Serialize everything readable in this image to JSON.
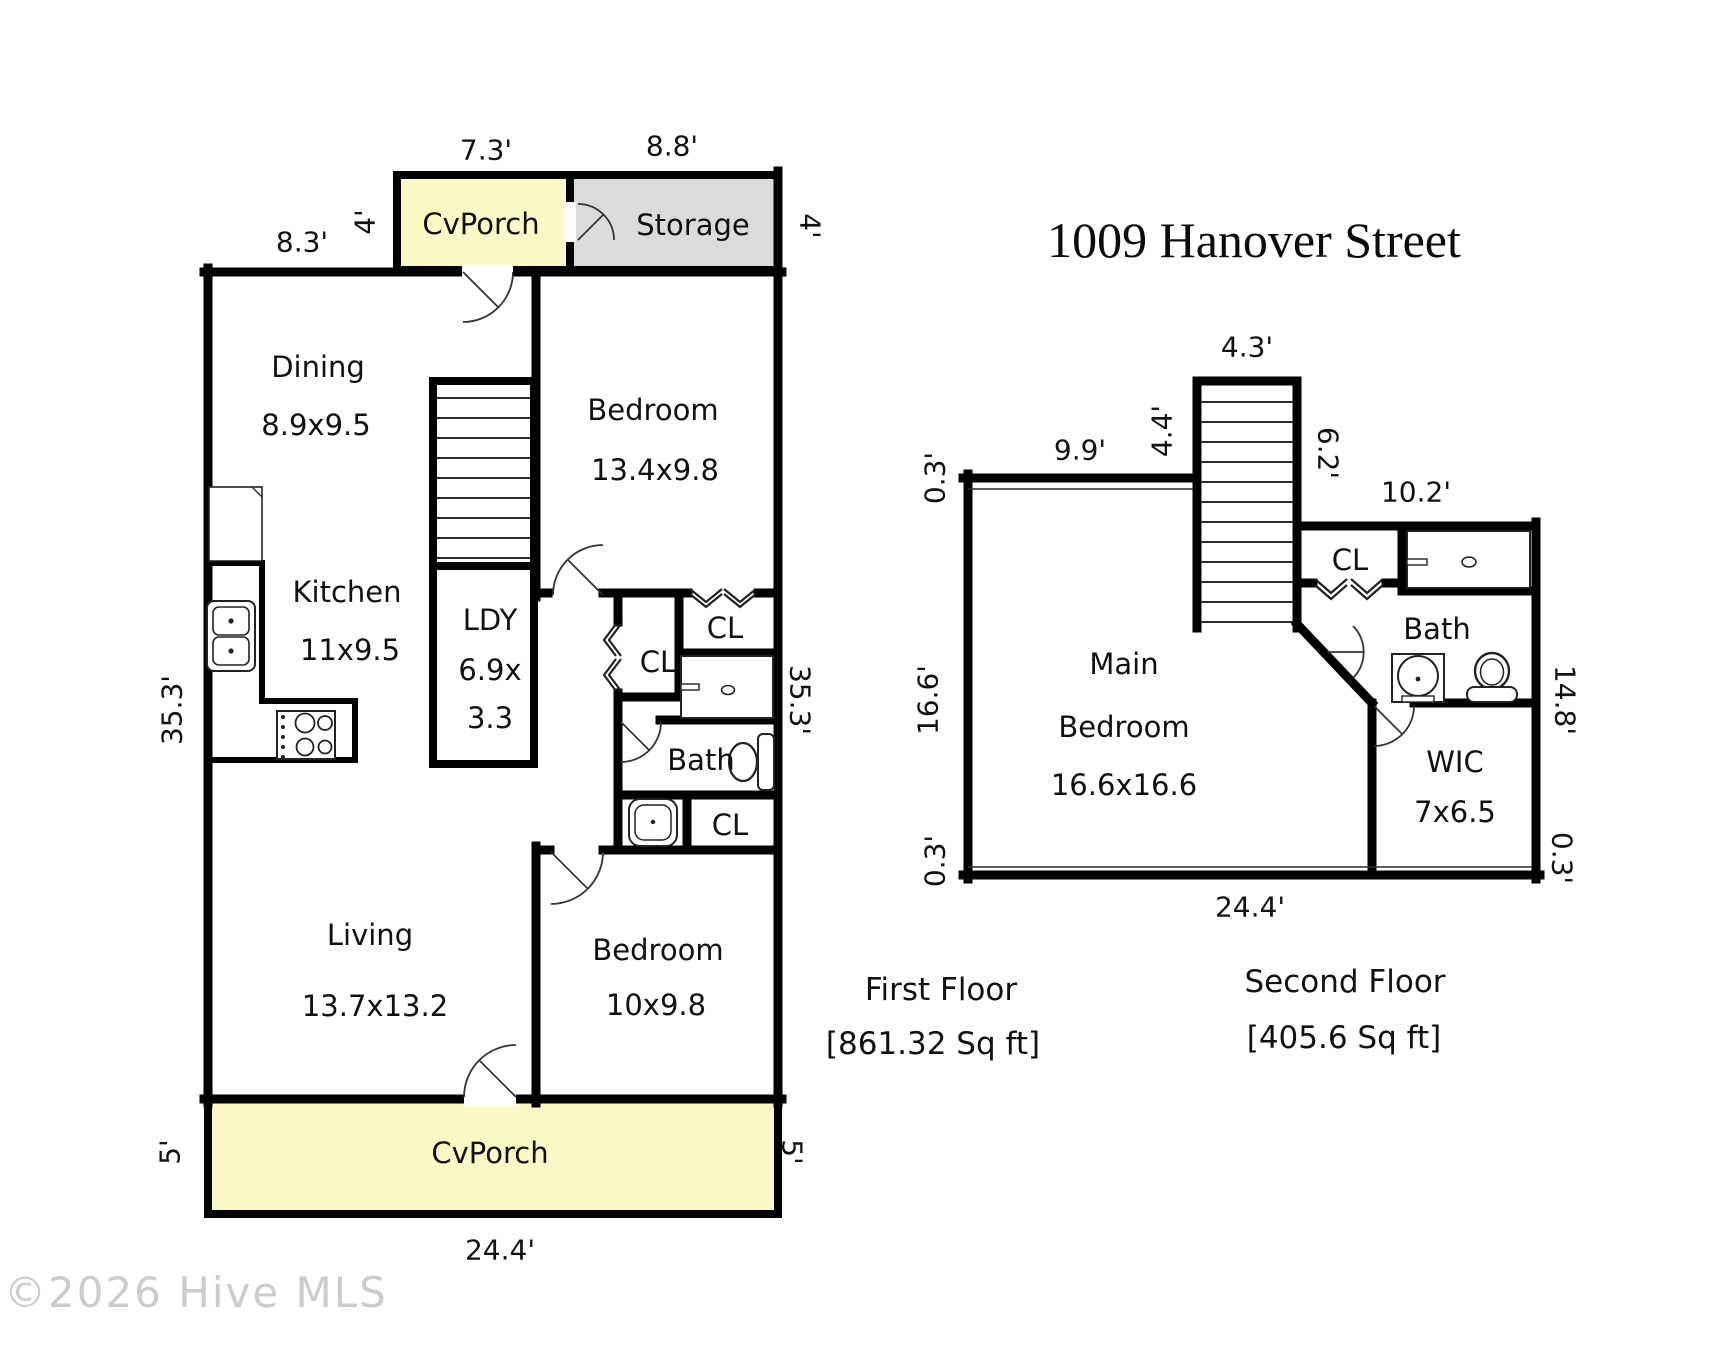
{
  "title": "1009 Hanover Street",
  "watermark": "©2026 Hive MLS",
  "colors": {
    "porch_fill": "#FAF9C6",
    "storage_fill": "#DBDBDB",
    "wall": "#000000"
  },
  "first_floor": {
    "caption": "First Floor",
    "area": "[861.32 Sq ft]",
    "rooms": {
      "porch_top": "CvPorch",
      "storage": "Storage",
      "dining": "Dining",
      "dining_size": "8.9x9.5",
      "kitchen": "Kitchen",
      "kitchen_size": "11x9.5",
      "laundry": "LDY",
      "laundry_size1": "6.9x",
      "laundry_size2": "3.3",
      "bedroom1": "Bedroom",
      "bedroom1_size": "13.4x9.8",
      "closet_top": "CL",
      "closet_mid": "CL",
      "bath": "Bath",
      "closet_bottom": "CL",
      "living": "Living",
      "living_size": "13.7x13.2",
      "bedroom2": "Bedroom",
      "bedroom2_size": "10x9.8",
      "porch_bottom": "CvPorch"
    },
    "dims": {
      "top_porch": "7.3'",
      "top_storage": "8.8'",
      "top_left": "8.3'",
      "porch_side_left": "4'",
      "storage_side_right": "4'",
      "left_height": "35.3'",
      "right_height": "35.3'",
      "porch_left": "5'",
      "porch_right": "5'",
      "bottom_width": "24.4'"
    }
  },
  "second_floor": {
    "caption": "Second Floor",
    "area": "[405.6 Sq ft]",
    "rooms": {
      "main_bedroom_line1": "Main",
      "main_bedroom_line2": "Bedroom",
      "main_bedroom_size": "16.6x16.6",
      "closet": "CL",
      "bath": "Bath",
      "wic": "WIC",
      "wic_size": "7x6.5"
    },
    "dims": {
      "stairs_top": "4.3'",
      "left_top": "9.9'",
      "stairs_left": "4.4'",
      "offset_top_left": "0.3'",
      "stairs_right": "6.2'",
      "top_right": "10.2'",
      "left_height": "16.6'",
      "offset_bottom_left": "0.3'",
      "right_height": "14.8'",
      "offset_bottom_right": "0.3'",
      "bottom_width": "24.4'"
    }
  }
}
